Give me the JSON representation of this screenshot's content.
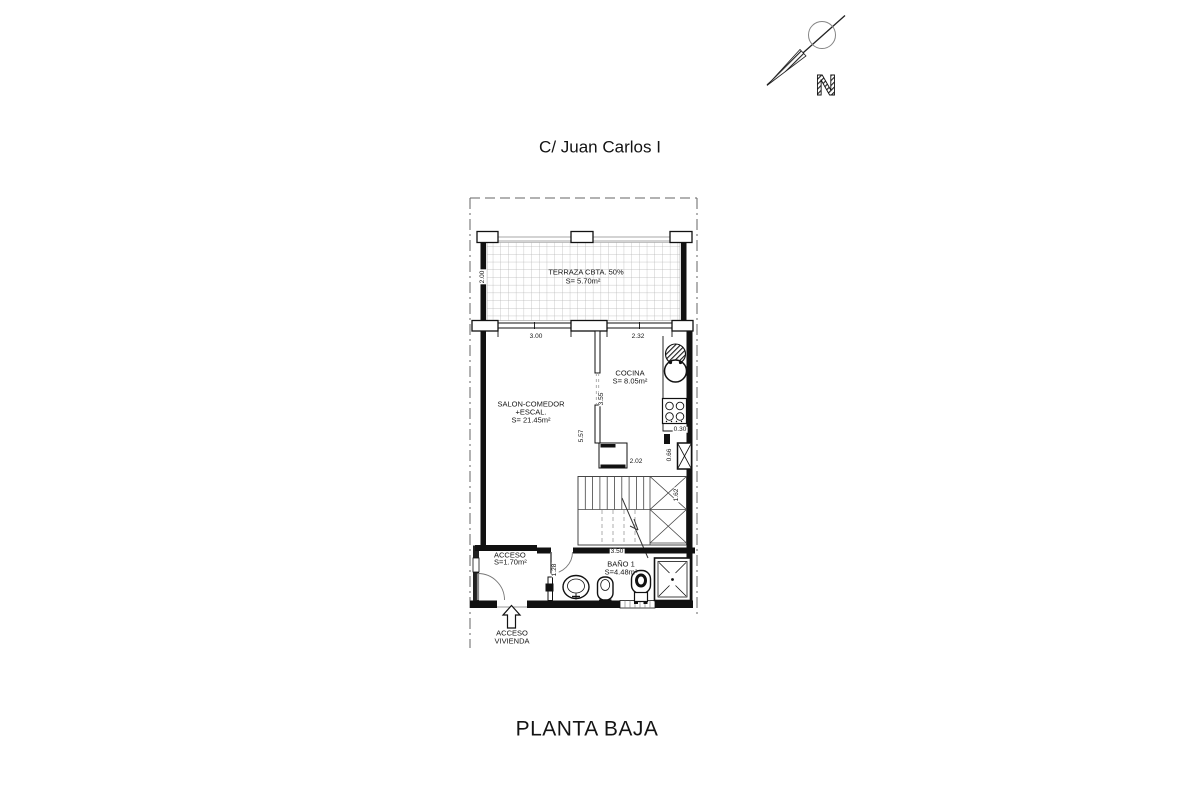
{
  "header": {
    "street_label": "C/ Juan Carlos I"
  },
  "footer": {
    "plan_title": "PLANTA BAJA"
  },
  "north": {
    "label": "N"
  },
  "rooms": {
    "terraza": {
      "name": "TERRAZA CBTA. 50%",
      "area": "S= 5.70m²"
    },
    "salon": {
      "name": "SALON-COMEDOR",
      "name2": "+ESCAL.",
      "area": "S= 21.45m²"
    },
    "cocina": {
      "name": "COCINA",
      "area": "S= 8.05m²"
    },
    "bano": {
      "name": "BAÑO 1",
      "area": "S=4.48m²"
    },
    "acceso": {
      "name": "ACCESO",
      "area": "S=1.70m²"
    },
    "entrance": {
      "line1": "ACCESO",
      "line2": "VIVIENDA"
    }
  },
  "dimensions": {
    "terraza_depth": "2.00",
    "salon_window": "3.00",
    "cocina_window": "2.32",
    "cocina_depth": "3.55",
    "salon_depth": "5.57",
    "counter_depth": "0.30",
    "cocina_width": "2.02",
    "shaft_height": "0.66",
    "stair_width": "1.62",
    "bano_width": "3.50",
    "corridor_width": "1.28"
  },
  "colors": {
    "line": "#1a1a1a",
    "tile_grid": "#b4b4b4",
    "boundary": "#666666"
  }
}
